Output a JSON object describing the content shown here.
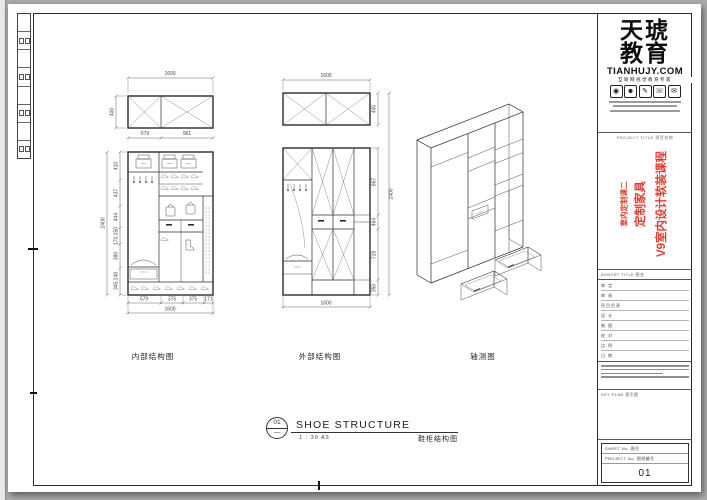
{
  "colors": {
    "bg": "#a9a9a9",
    "sheet": "#ffffff",
    "line": "#2b2b2b",
    "red": "#e23b2c",
    "dim_text": "#444444"
  },
  "views": {
    "internal": {
      "label": "内部结构图",
      "top_total": "1600",
      "top_height": "400",
      "sub_left": "579",
      "sub_right": "961",
      "left_total": "2400",
      "left_chain": [
        "410",
        "437",
        "444",
        "170,150",
        "380",
        "345,148"
      ],
      "bottom_chain": [
        "579",
        "375",
        "375",
        "171"
      ],
      "bottom_total": "1600"
    },
    "external": {
      "label": "外部结构图",
      "top_total": "1600",
      "top_height": "400",
      "right_chain": [
        "867",
        "464",
        "719",
        "350"
      ],
      "right_total": "2400",
      "bottom_total": "1600"
    },
    "axon": {
      "label": "轴测图"
    }
  },
  "title_bar": {
    "number": "01",
    "dash": "—",
    "title": "SHOE STRUCTURE",
    "scale": "1 : 30  A3",
    "subtitle": "鞋柜结构图"
  },
  "brand": {
    "name_top": "天琥",
    "name_bottom": "教育",
    "domain": "TIANHUJY.COM",
    "tagline": "互联网视觉教育专家",
    "icon_names": [
      "eye-icon",
      "people-icon",
      "pen-icon",
      "phone-icon",
      "mail-icon"
    ],
    "icon_glyphs": [
      "◉",
      "☻",
      "✎",
      "☏",
      "✉"
    ]
  },
  "project": {
    "header": "PROJECT TITLE 项目名称",
    "line1": "V9室内设计软装课程",
    "line2": "定制家具",
    "line3": "室内定制课二"
  },
  "assort_label": "ASSORT TITLE 图名",
  "fields": [
    {
      "label": "审 定"
    },
    {
      "label": "审 核"
    },
    {
      "label": "项目负责"
    },
    {
      "label": "设 计"
    },
    {
      "label": "制 图"
    },
    {
      "label": "校 对"
    },
    {
      "label": "比 例"
    },
    {
      "label": "日 期"
    }
  ],
  "key_plan_label": "KEY PLAN 索引图",
  "sheet_no_label": "SHEET No. 图号",
  "project_no_label": "PROJECT No. 图纸编号",
  "page_number": "01"
}
